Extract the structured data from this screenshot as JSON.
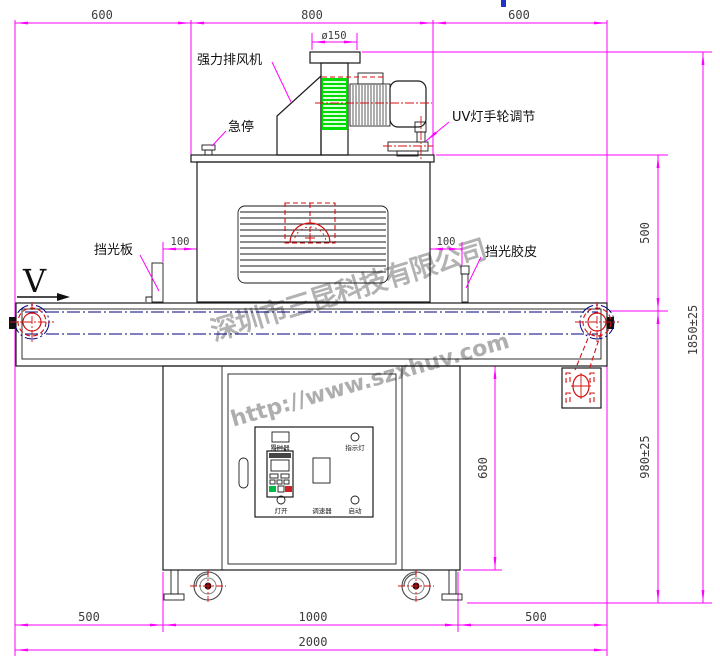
{
  "dims": {
    "top_left": "600",
    "top_mid": "800",
    "top_right": "600",
    "duct_dia": "ø150",
    "gap_left": "100",
    "gap_right": "100",
    "oven_to_belt": "500",
    "overall_height": "1850±25",
    "belt_height": "980±25",
    "cabinet_height": "680",
    "bottom_left": "500",
    "bottom_mid": "1000",
    "bottom_right": "500",
    "overall_length": "2000"
  },
  "labels": {
    "exhaust_fan": "强力排风机",
    "emergency_stop": "急停",
    "uv_handwheel": "UV灯手轮调节",
    "shade_plate": "挡光板",
    "shade_rubber": "挡光胶皮",
    "belt_direction": "V"
  },
  "panel": {
    "timer": "累时器",
    "indicator": "指示灯",
    "lamp_on": "灯开",
    "speed": "调速器",
    "start": "启动"
  },
  "watermark": {
    "company": "深圳市三昆科技有限公司",
    "url": "http://www.szxhuv.com"
  },
  "colors": {
    "dimension": "#ff00ff",
    "centerline_blue": "#000080",
    "detail_red": "#d41111",
    "fan_green": "#00dd00",
    "watermark_gray": "#a0a0a0"
  }
}
